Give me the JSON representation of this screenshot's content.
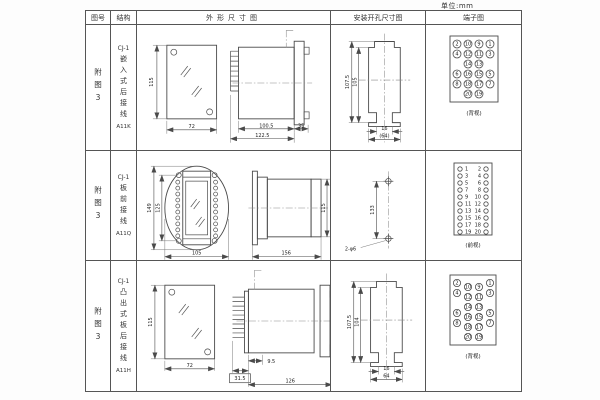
{
  "page": {
    "unit": "单位:mm"
  },
  "table": {
    "headers": {
      "col1": "图号",
      "col2": "结构",
      "col3": "外形尺寸图",
      "col4": "安装开孔尺寸图",
      "col5": "端子图"
    },
    "rows": [
      {
        "figure_no": "附图3",
        "structure": {
          "model": "CJ-1",
          "desc": "嵌入式后接线",
          "code": "A11K"
        },
        "outline": {
          "front_height": "115",
          "front_width": "72",
          "side_body": "100.5",
          "side_overall": "122.5",
          "side_flange": "35"
        },
        "mounting": {
          "height_outer": "107.5",
          "height_inner": "105",
          "slot_width": "16",
          "overall_width": "(64)"
        },
        "terminal": {
          "view_label": "(背视)",
          "type": "grid",
          "stagger": false,
          "rows": [
            [
              2,
              10,
              9,
              1
            ],
            [
              4,
              12,
              11,
              3
            ],
            [
              null,
              14,
              13,
              null
            ],
            [
              6,
              16,
              15,
              5
            ],
            [
              8,
              18,
              17,
              7
            ],
            [
              null,
              20,
              19,
              null
            ]
          ]
        }
      },
      {
        "figure_no": "附图3",
        "structure": {
          "model": "CJ-1",
          "desc": "板前接线",
          "code": "A11Q"
        },
        "outline": {
          "front_height_outer": "149",
          "front_height_inner": "125",
          "front_width": "105",
          "side_length": "156",
          "side_height": "115"
        },
        "mounting": {
          "hole_distance": "133",
          "holes_label": "2-φ6"
        },
        "terminal": {
          "view_label": "(前视)",
          "type": "pairs",
          "left": [
            1,
            3,
            5,
            7,
            9,
            11,
            13,
            15,
            17,
            19
          ],
          "right": [
            2,
            4,
            6,
            8,
            10,
            12,
            14,
            16,
            18,
            20
          ]
        }
      },
      {
        "figure_no": "附图3",
        "structure": {
          "model": "CJ-1",
          "desc": "凸出式板后接线",
          "code": "A11H"
        },
        "outline": {
          "front_height": "115",
          "front_width": "72",
          "side_pitch": "9.5",
          "side_depth": "31.5",
          "side_length": "126"
        },
        "mounting": {
          "height_outer": "107.5",
          "height_inner": "104",
          "slot_width": "16",
          "overall_width": "64"
        },
        "terminal": {
          "view_label": "(背视)",
          "type": "grid",
          "stagger": true,
          "rows": [
            [
              2,
              10,
              9,
              1
            ],
            [
              4,
              12,
              11,
              3
            ],
            [
              null,
              14,
              13,
              null
            ],
            [
              6,
              16,
              15,
              5
            ],
            [
              8,
              18,
              17,
              7
            ],
            [
              null,
              20,
              19,
              null
            ]
          ]
        }
      }
    ]
  }
}
